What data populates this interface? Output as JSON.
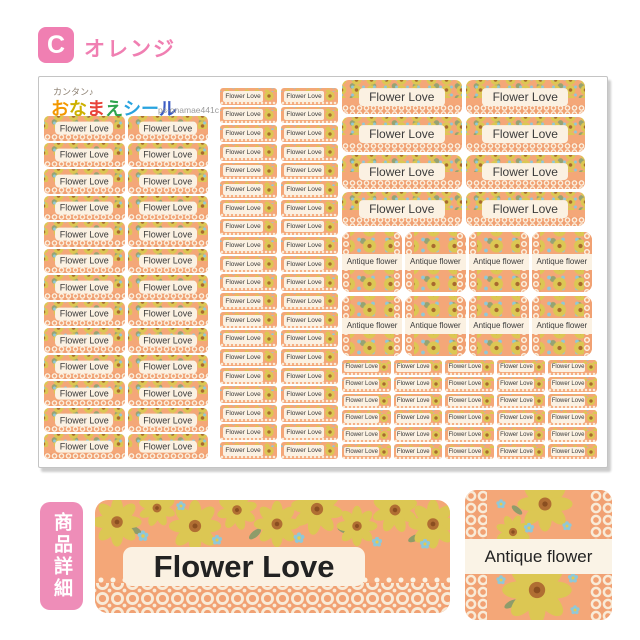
{
  "variant": {
    "letter": "C",
    "name": "オレンジ"
  },
  "sheet": {
    "tagline": "カンタン♪",
    "logo_chars": [
      {
        "ch": "お",
        "color": "#F39800"
      },
      {
        "ch": "な",
        "color": "#CDB000"
      },
      {
        "ch": "ま",
        "color": "#E8443A"
      },
      {
        "ch": "え",
        "color": "#2EA44E"
      },
      {
        "ch": "シ",
        "color": "#29A3DF"
      },
      {
        "ch": "ー",
        "color": "#29A3DF"
      },
      {
        "ch": "ル",
        "color": "#3B5BC4"
      }
    ],
    "product_code": "ps-onamae441c",
    "blocks": {
      "left": {
        "rows": 13,
        "cols": 2,
        "label": "Flower Love",
        "style": "band",
        "name": "name-sticker-medium"
      },
      "middle": {
        "rows": 20,
        "cols": 2,
        "label": "Flower Love",
        "style": "side",
        "name": "name-sticker-small"
      },
      "top_right": {
        "rows": 4,
        "cols": 2,
        "label": "Flower Love",
        "style": "band",
        "name": "name-sticker-large"
      },
      "antique": {
        "rows": 2,
        "cols": 4,
        "label": "Antique flower",
        "style": "ant",
        "name": "name-sticker-square"
      },
      "bottom_right": {
        "rows": 6,
        "cols": 5,
        "label": "Flower Love",
        "style": "side",
        "name": "name-sticker-mini"
      }
    }
  },
  "details": {
    "section_label": "商品詳細",
    "large_sticker_label": "Flower Love",
    "square_sticker_label": "Antique flower"
  },
  "colors": {
    "accent_pink": "#F07FB2",
    "sticker_salmon": "#F4A778",
    "label_cream": "#FBF1E2",
    "flower_yellow": "#DCC753",
    "flower_center_brown": "#A8692F",
    "flower_blue": "#8FC8D8",
    "leaf_green": "#96A372"
  }
}
